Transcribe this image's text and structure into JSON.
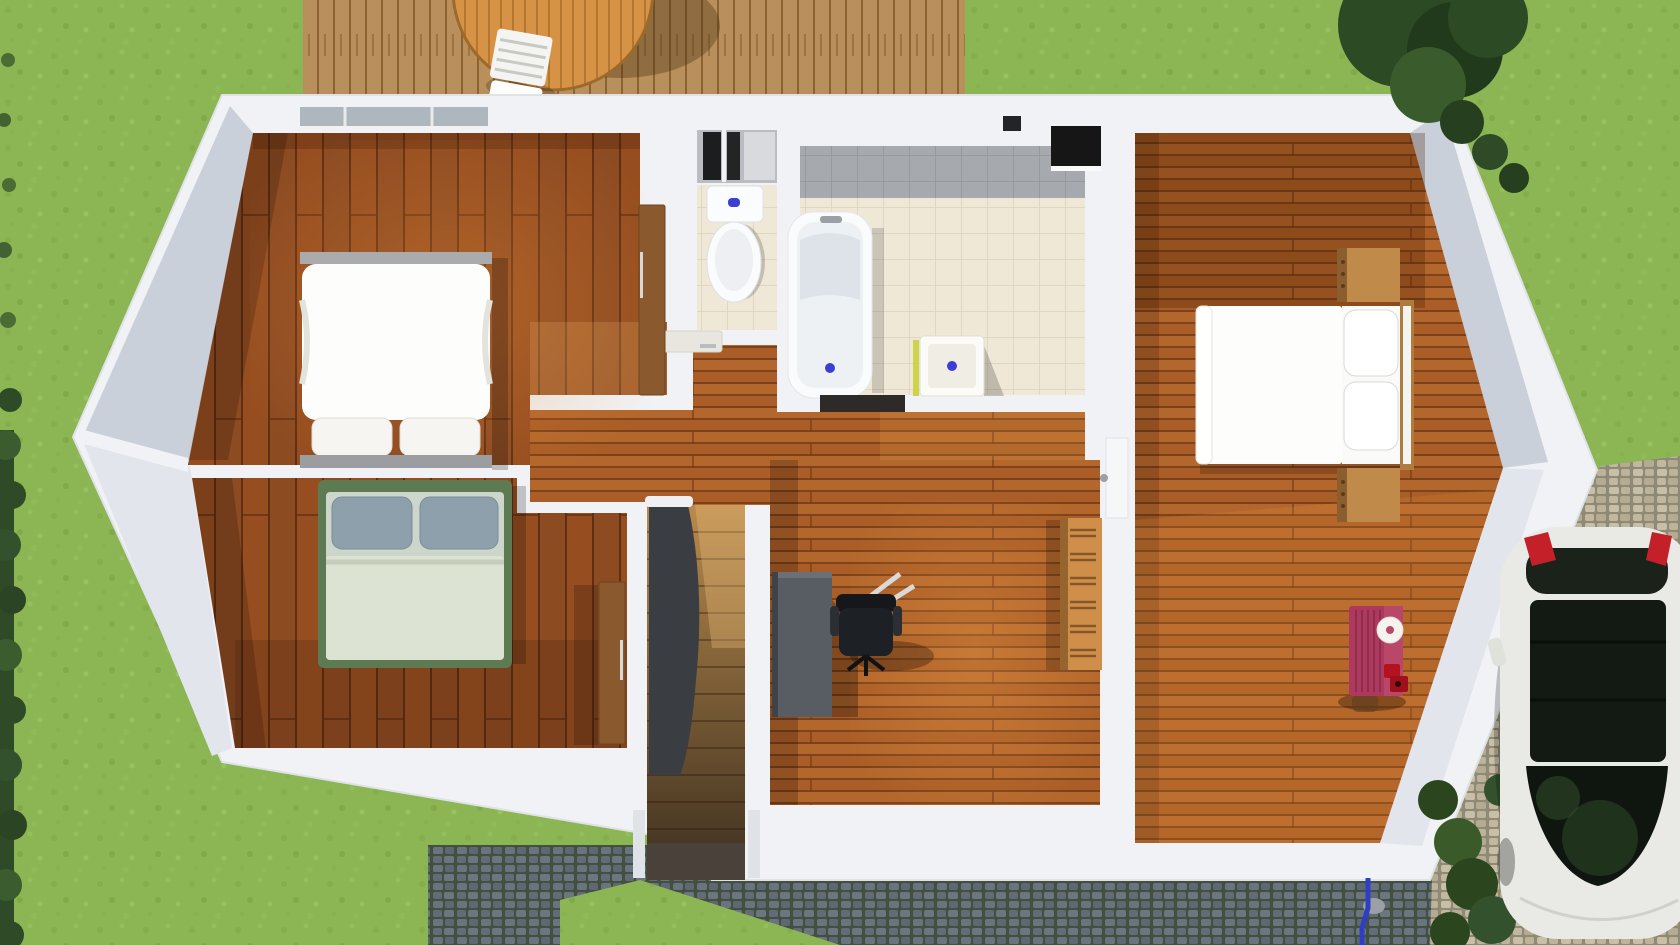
{
  "meta": {
    "kind": "3d-architectural-floorplan-render",
    "view": "top-down",
    "content": "upper floor of a house with two left bedrooms, WC, bathroom, central staircase, office area and right bedroom, surrounded by garden, wooden deck, cobblestone driveway and a parked car"
  },
  "palette": {
    "grass": "#8cb654",
    "grassLight": "#9ac563",
    "hedge": "#2e4a26",
    "tree": "#2c4a24",
    "deck": "#b9905c",
    "tableWood": "#d69245",
    "chairWhite": "#f4f4f2",
    "cobbleDarkBase": "#44503f",
    "cobbleLightBase": "#8e8a76",
    "wall": "#f1f2f5",
    "wallShadeTop": "#c9d0da",
    "wallShadeBottom": "#e2e6ec",
    "plankDark": "#8d4b22",
    "plankMid": "#b4672c",
    "tileBeige": "#efe8d7",
    "tileGray": "#a6aaaf",
    "tubWhite": "#fafbfc",
    "tubInner": "#eef1f4",
    "accentBlue": "#3c3ed4",
    "towelGreen": "#cdd34a",
    "radiatorBlack": "#161616",
    "banister": "#3a3d41",
    "railCap": "#eef0f3",
    "deskGray": "#585d63",
    "chairBlack": "#1d2024",
    "shelfWood": "#cf8f4b",
    "bedWhite": "#fdfdfb",
    "headboardGray": "#9b9da0",
    "bedGreen": "#5e7a52",
    "pillowBlue": "#8ea0ac",
    "duvetSage": "#dde3d2",
    "nightstandWood": "#c08a4a",
    "dresserRed": "#ad3a5e",
    "toyRed": "#b5121f",
    "doorWood": "#8a5a2e",
    "doorWhite": "#f6f7f8",
    "carBody": "#e9eae5",
    "carGlass": "#131a13",
    "carTail": "#c4202a",
    "pipeBlue": "#2f3fc4",
    "windowGray": "#aeb6be"
  },
  "rooms": [
    {
      "name": "bedroom-top-left",
      "floor": "dark-wood-vertical-planks"
    },
    {
      "name": "bedroom-bottom-left",
      "floor": "dark-wood-vertical-planks"
    },
    {
      "name": "wc",
      "floor": "beige-tiles"
    },
    {
      "name": "bathroom",
      "floor": "beige-tiles-gray-band"
    },
    {
      "name": "hallway",
      "floor": "orange-wood-horizontal-planks"
    },
    {
      "name": "staircase",
      "floor": "wood-steps"
    },
    {
      "name": "office",
      "floor": "orange-wood-horizontal-planks"
    },
    {
      "name": "bedroom-right",
      "floor": "orange-wood-horizontal-planks"
    }
  ],
  "furniture": [
    "double-bed-white",
    "double-bed-green",
    "double-bed-right-with-headboard",
    "toilet",
    "bathtub",
    "sink",
    "radiator",
    "desk",
    "office-chair",
    "bookshelf",
    "red-dresser",
    "nightstand-top",
    "nightstand-bottom",
    "wardrobe-door-bedroom1",
    "wardrobe-door-bedroom2",
    "wc-door",
    "bedroom-right-door",
    "garden-table-round",
    "garden-chair-white"
  ],
  "environment": [
    "lawn",
    "left-hedge",
    "top-right-tree",
    "corner-bushes",
    "wood-deck",
    "dark-cobblestone-path",
    "light-cobblestone-driveway",
    "white-car",
    "blue-garden-pipe"
  ]
}
